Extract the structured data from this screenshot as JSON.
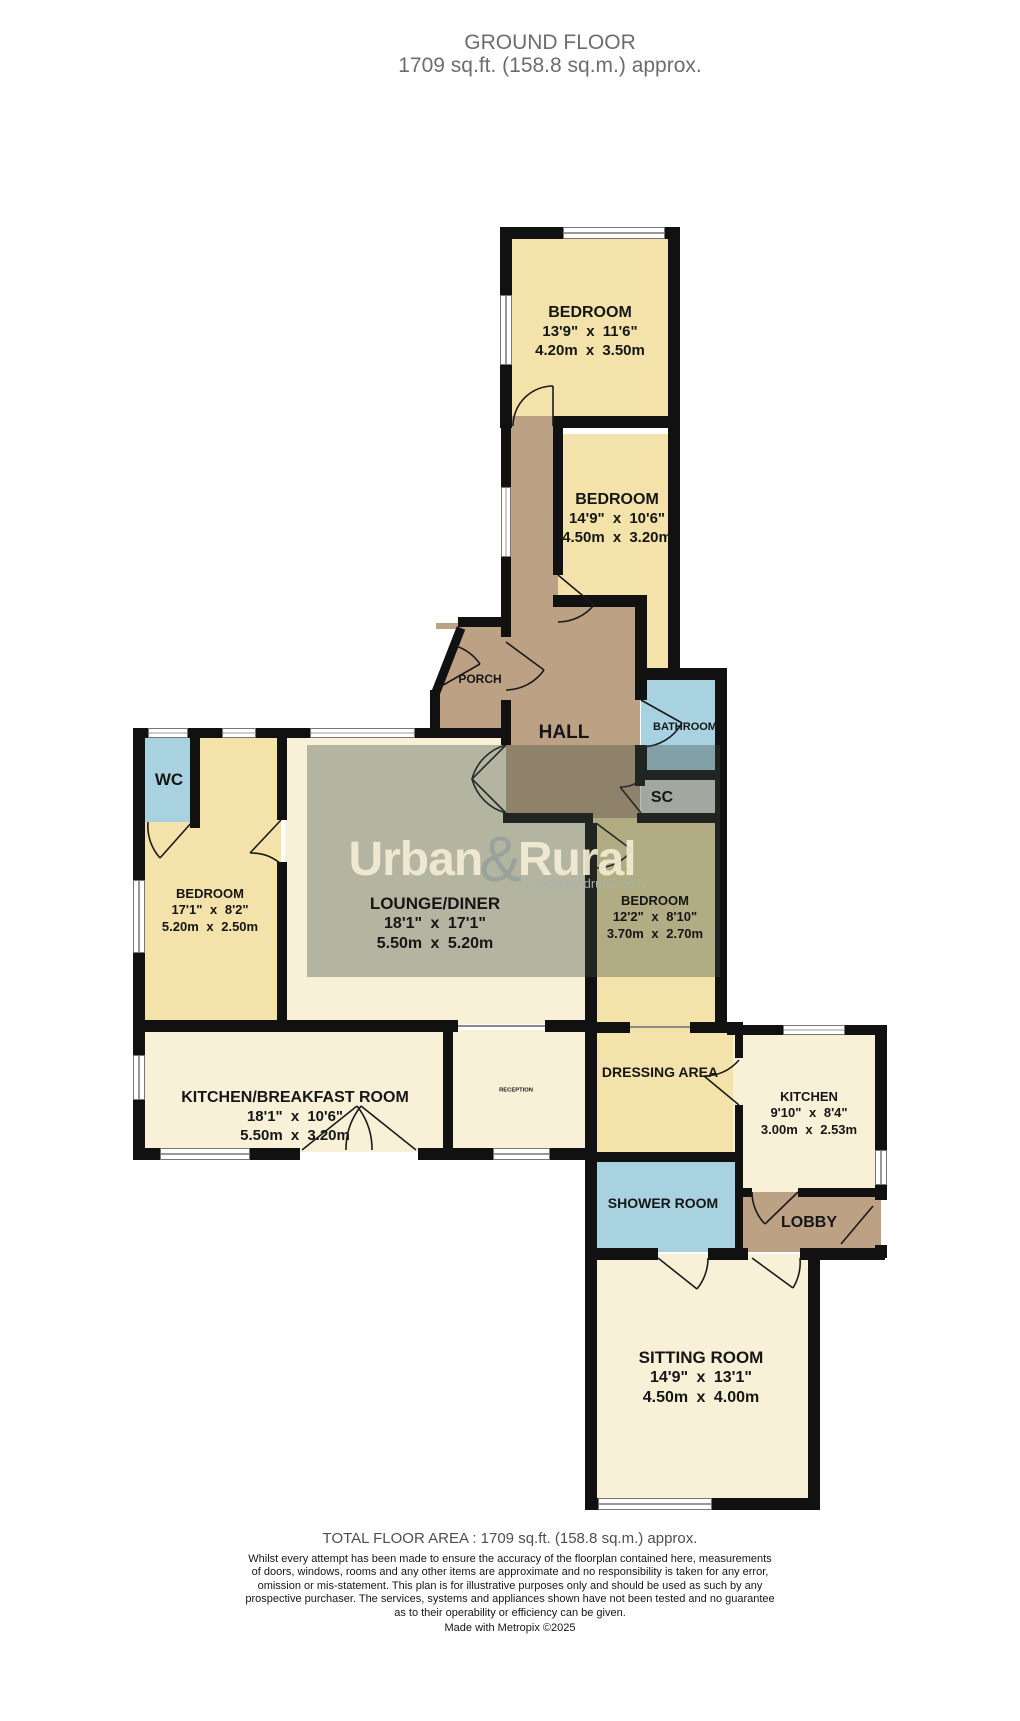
{
  "title": {
    "line1": "GROUND FLOOR",
    "line2": "1709 sq.ft. (158.8 sq.m.) approx."
  },
  "watermark": {
    "brand_first": "Urban",
    "ampersand": "&",
    "brand_second": "Rural",
    "website": "urbanandrural.com"
  },
  "rooms": {
    "bedroom_top": {
      "name": "BEDROOM",
      "imperial": "13'9\" x 11'6\"",
      "metric": "4.20m x 3.50m"
    },
    "bedroom_two": {
      "name": "BEDROOM",
      "imperial": "14'9\" x 10'6\"",
      "metric": "4.50m x 3.20m"
    },
    "bedroom_left": {
      "name": "BEDROOM",
      "imperial": "17'1\" x 8'2\"",
      "metric": "5.20m x 2.50m"
    },
    "lounge": {
      "name": "LOUNGE/DINER",
      "imperial": "18'1\" x 17'1\"",
      "metric": "5.50m x 5.20m"
    },
    "bedroom_four": {
      "name": "BEDROOM",
      "imperial": "12'2\" x 8'10\"",
      "metric": "3.70m x 2.70m"
    },
    "kitchen_breakfast": {
      "name": "KITCHEN/BREAKFAST ROOM",
      "imperial": "18'1\" x 10'6\"",
      "metric": "5.50m x 3.20m"
    },
    "kitchen": {
      "name": "KITCHEN",
      "imperial": "9'10\" x 8'4\"",
      "metric": "3.00m x 2.53m"
    },
    "sitting": {
      "name": "SITTING ROOM",
      "imperial": "14'9\" x 13'1\"",
      "metric": "4.50m x 4.00m"
    }
  },
  "labels": {
    "porch": "PORCH",
    "hall": "HALL",
    "bathroom": "BATHROOM",
    "sc": "SC",
    "wc": "WC",
    "dressing": "DRESSING AREA",
    "shower": "SHOWER ROOM",
    "lobby": "LOBBY",
    "reception": "RECEPTION"
  },
  "footer": {
    "total": "TOTAL FLOOR AREA : 1709 sq.ft. (158.8 sq.m.) approx.",
    "disclaimer": [
      "Whilst every attempt has been made to ensure the accuracy of the floorplan contained here, measurements",
      "of doors, windows, rooms and any other items are approximate and no responsibility is taken for any error,",
      "omission or mis-statement. This plan is for illustrative purposes only and should be used as such by any",
      "prospective purchaser. The services, systems and appliances shown have not been tested and no guarantee",
      "as to their operability or efficiency can be given."
    ],
    "credit": "Made with Metropix ©2025"
  },
  "colors": {
    "room_yellow": "#f3e3ab",
    "room_cream": "#f8f1d8",
    "room_blue": "#a9d2e1",
    "room_tan": "#bda184",
    "room_gray": "#dcdcd6",
    "wall": "#111111",
    "title_gray": "#6d6d6d",
    "watermark_overlay": "rgba(62,76,64,0.36)",
    "watermark_text": "#f2edd3"
  }
}
